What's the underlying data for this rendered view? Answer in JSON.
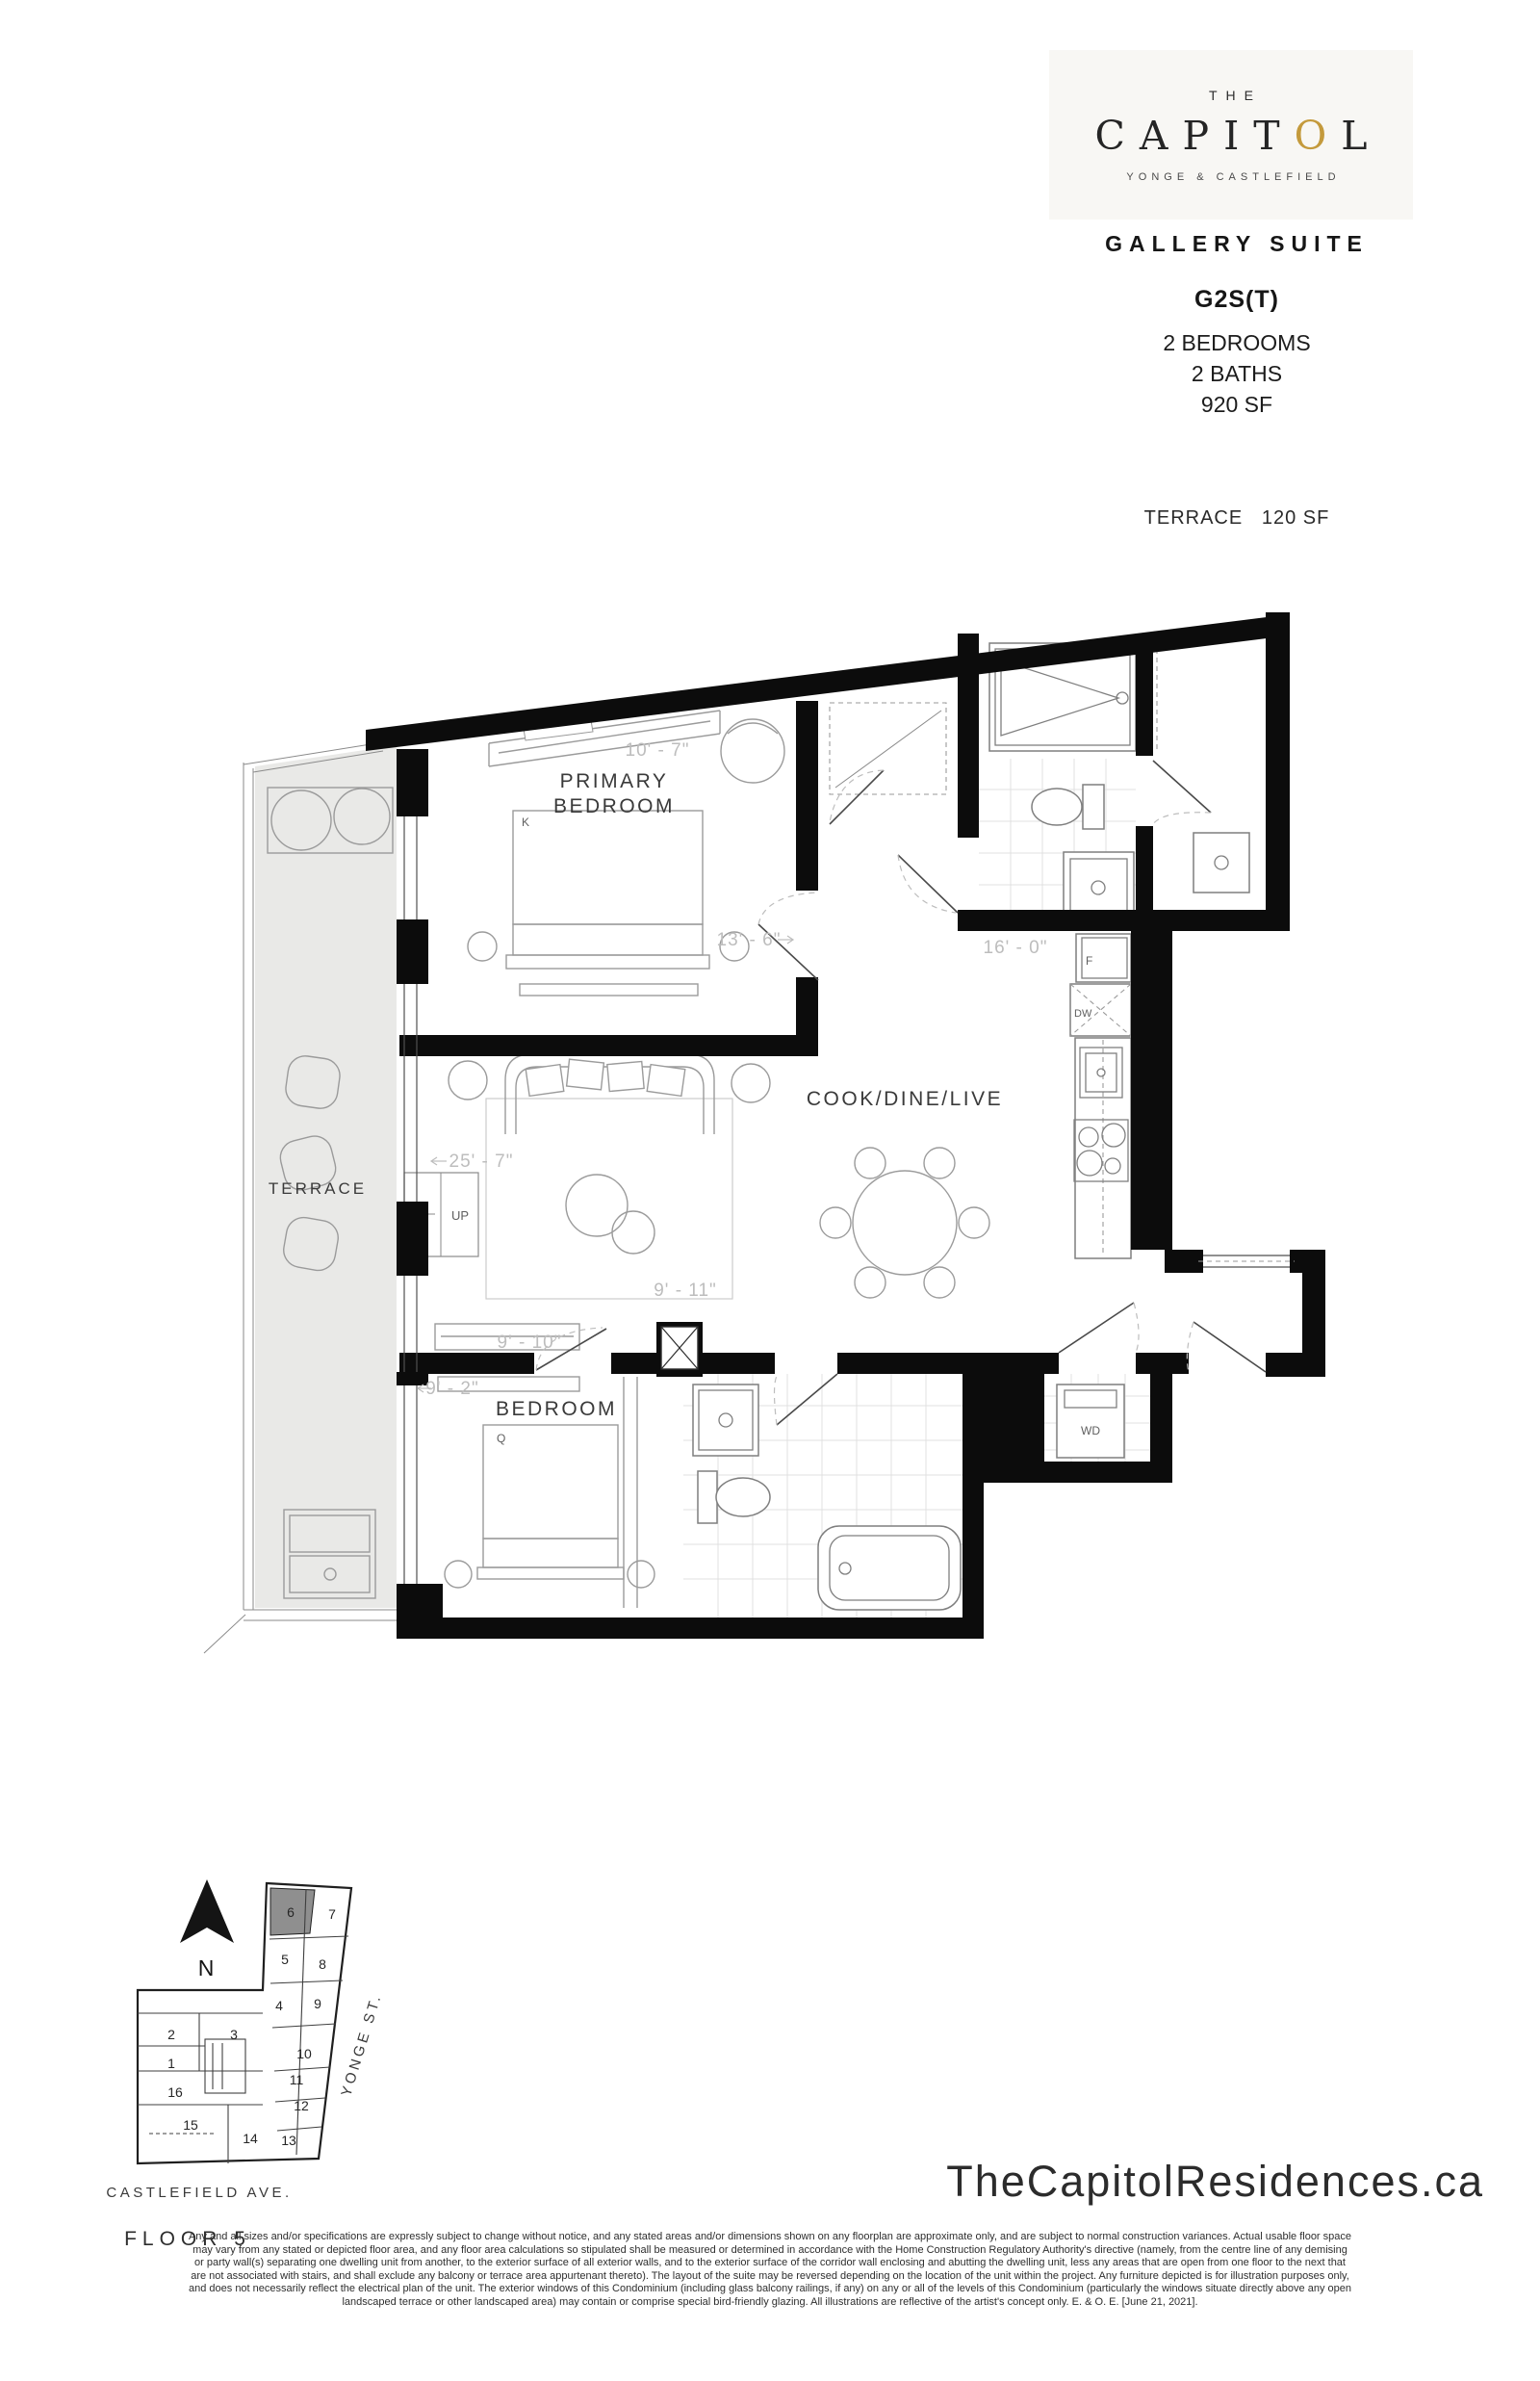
{
  "brand": {
    "the": "THE",
    "name_pre": "CAPIT",
    "name_gold": "O",
    "name_post": "L",
    "tagline": "YONGE & CASTLEFIELD",
    "gold_color": "#c49a3c"
  },
  "header": {
    "suite_name": "GALLERY SUITE",
    "unit_code": "G2S(T)",
    "spec_lines": [
      "2 BEDROOMS",
      "2 BATHS",
      "920 SF"
    ],
    "terrace_spec": "TERRACE   120 SF"
  },
  "plan": {
    "rooms": {
      "primary_line1": "PRIMARY",
      "primary_line2": "BEDROOM",
      "living": "COOK/DINE/LIVE",
      "bedroom": "BEDROOM",
      "terrace": "TERRACE"
    },
    "dims": {
      "primary_w": "10' - 7\"",
      "primary_d": "13' - 6\"",
      "kitchen": "16' - 0\"",
      "living_l": "25' - 7\"",
      "living_w": "9' - 11\"",
      "bedroom_w": "9' - 10\"",
      "bedroom_d": "9' - 2\""
    },
    "tags": {
      "king": "K",
      "queen": "Q",
      "fridge": "F",
      "dishwasher": "DW",
      "washer_dryer": "WD",
      "up": "UP"
    }
  },
  "keyplan": {
    "north": "N",
    "unit_labels": [
      "1",
      "2",
      "3",
      "4",
      "5",
      "6",
      "7",
      "8",
      "9",
      "10",
      "11",
      "12",
      "13",
      "14",
      "15",
      "16"
    ],
    "highlighted_unit": "6",
    "yonge": "YONGE ST.",
    "castlefield": "CASTLEFIELD AVE.",
    "floor": "FLOOR 5"
  },
  "footer": {
    "website": "TheCapitolResidences.ca",
    "disclaimer": [
      "Any and all sizes and/or specifications are expressly subject to change without notice, and any stated areas and/or dimensions shown on any floorplan are approximate only, and are subject to normal construction variances. Actual usable floor space",
      "may vary from any stated or depicted floor area, and any floor area calculations so stipulated shall be measured or determined in accordance with the Home Construction Regulatory Authority's directive (namely, from the centre line of any demising",
      "or party wall(s) separating one dwelling unit from another, to the exterior surface of all exterior walls, and to the exterior surface of the corridor wall enclosing and abutting the dwelling unit, less any areas that are open from one floor to the next that",
      "are not associated with stairs, and shall exclude any balcony or terrace area appurtenant thereto). The layout of the suite may be reversed depending on the location of the unit within the project. Any furniture depicted is for illustration purposes only,",
      "and does not necessarily reflect the electrical plan of the unit. The exterior windows of this Condominium (including glass balcony railings, if any) on any or all of the levels of this Condominium (particularly the windows situate directly above any open",
      "landscaped terrace or other landscaped area) may contain or comprise special bird-friendly glazing. All illustrations are reflective of the artist's concept only. E. & O. E. [June 21, 2021]."
    ]
  }
}
